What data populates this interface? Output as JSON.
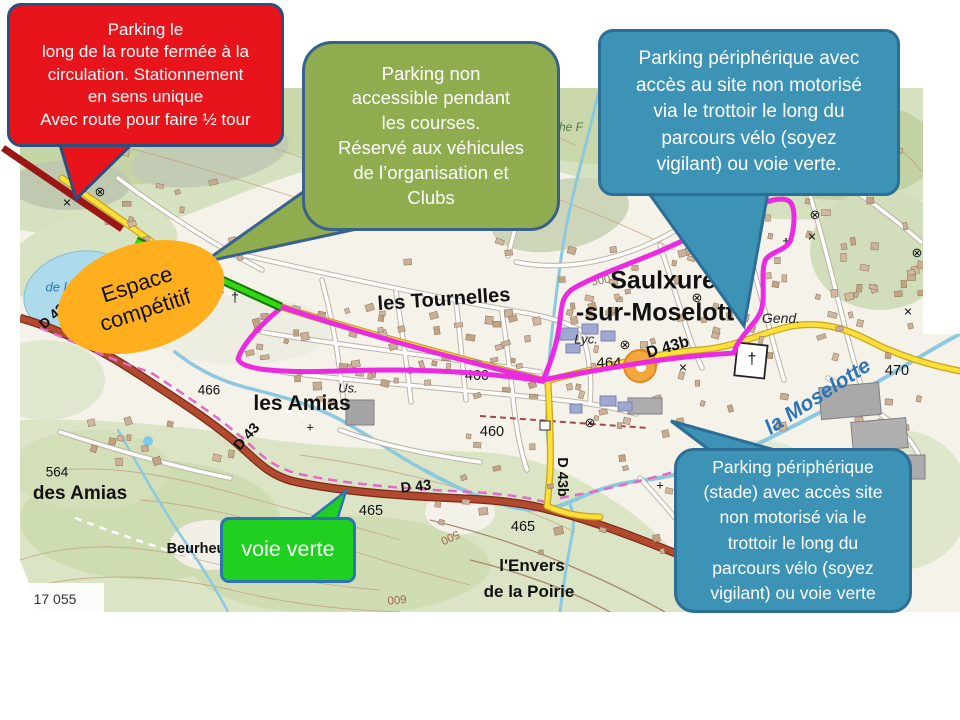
{
  "callouts": {
    "parking_route_fermee": {
      "text": "Parking le\nlong de la route fermée à la\ncirculation. Stationnement\nen sens unique\nAvec route pour faire ½ tour",
      "fill": "#E8141C",
      "border": "#2A5080"
    },
    "parking_non_accessible": {
      "text": "Parking non\naccessible pendant\nles  courses.\nRéservé aux véhicules\nde l’organisation et\nClubs",
      "fill": "#8FAC4F",
      "border": "#38618C"
    },
    "parking_peripherique_nord": {
      "text": "Parking périphérique   avec\naccès au site non motorisé\nvia le  trottoir le long du\nparcours vélo (soyez\nvigilant) ou voie verte.",
      "fill": "#3D93B5",
      "border": "#2C6E96"
    },
    "parking_peripherique_stade": {
      "text": "Parking périphérique\n(stade)  avec  accès site\nnon motorisé via le\ntrottoir le long  du\nparcours vélo (soyez\nvigilant) ou voie verte",
      "fill": "#3D93B5",
      "border": "#2C6E96"
    },
    "espace_competitif": {
      "text": "Espace\ncompétitif",
      "fill": "#FFAF1E"
    },
    "voie_verte": {
      "text": "voie verte",
      "fill": "#20D020",
      "border": "#2E74B5"
    }
  },
  "overlay_colors": {
    "parcours_route": "#EA2BE2",
    "route_fermee_line": "#9D1616",
    "acces_organisation_line": "#35D613"
  },
  "map_labels": [
    {
      "t": "les Tournelles",
      "x": 444,
      "y": 300,
      "s": 20,
      "w": 600,
      "rot": -4
    },
    {
      "t": "Saulxures",
      "x": 670,
      "y": 281,
      "s": 25,
      "w": 700
    },
    {
      "t": "-sur-Moselotte",
      "x": 662,
      "y": 313,
      "s": 25,
      "w": 700
    },
    {
      "t": "les Amias",
      "x": 302,
      "y": 404,
      "s": 21,
      "w": 700
    },
    {
      "t": "des Amias",
      "x": 80,
      "y": 494,
      "s": 19,
      "w": 600
    },
    {
      "t": "564",
      "x": 57,
      "y": 472,
      "s": 13.5
    },
    {
      "t": "Beurheu",
      "x": 196,
      "y": 549,
      "s": 14.5,
      "w": 600
    },
    {
      "t": "l'Envers",
      "x": 532,
      "y": 566,
      "s": 17,
      "w": 700
    },
    {
      "t": "de la Poirie",
      "x": 529,
      "y": 592,
      "s": 17,
      "w": 700
    },
    {
      "t": "la Moselotte",
      "x": 818,
      "y": 397,
      "s": 21,
      "c": "#2C74B8",
      "i": 1,
      "rot": -33,
      "w": 600
    },
    {
      "t": "Gend.",
      "x": 781,
      "y": 318,
      "s": 14,
      "c": "#222",
      "i": 1
    },
    {
      "t": "Lyc.",
      "x": 586,
      "y": 339,
      "s": 13,
      "c": "#222",
      "i": 1
    },
    {
      "t": "Us.",
      "x": 348,
      "y": 388,
      "s": 13,
      "c": "#222",
      "i": 1
    },
    {
      "t": "464",
      "x": 609,
      "y": 363,
      "s": 15
    },
    {
      "t": "466",
      "x": 209,
      "y": 390,
      "s": 13.5
    },
    {
      "t": "460",
      "x": 477,
      "y": 376,
      "s": 14.5
    },
    {
      "t": "460",
      "x": 492,
      "y": 432,
      "s": 14.5
    },
    {
      "t": "465",
      "x": 371,
      "y": 511,
      "s": 14.5
    },
    {
      "t": "465",
      "x": 523,
      "y": 527,
      "s": 14.5
    },
    {
      "t": "470",
      "x": 897,
      "y": 371,
      "s": 14.5
    },
    {
      "t": "D 43",
      "x": 52,
      "y": 316,
      "s": 14,
      "rot": -42,
      "w": 600
    },
    {
      "t": "D 43",
      "x": 247,
      "y": 437,
      "s": 14.5,
      "rot": -48,
      "w": 600
    },
    {
      "t": "D 43",
      "x": 416,
      "y": 487,
      "s": 14.5,
      "rot": -6,
      "w": 600
    },
    {
      "t": "D 43b",
      "x": 668,
      "y": 348,
      "s": 16,
      "rot": -16,
      "w": 600
    },
    {
      "t": "D 43b",
      "x": 562,
      "y": 477,
      "s": 14.5,
      "rot": 90,
      "w": 600
    },
    {
      "t": "500",
      "x": 601,
      "y": 281,
      "s": 11.5,
      "c": "#7D7D55",
      "rot": -10
    },
    {
      "t": "500",
      "x": 450,
      "y": 537,
      "s": 11.5,
      "c": "#A06A4A",
      "rot": 155
    },
    {
      "t": "600",
      "x": 397,
      "y": 599,
      "s": 11.5,
      "c": "#A06A4A",
      "rot": 175
    },
    {
      "t": "che F",
      "x": 568,
      "y": 127,
      "s": 12,
      "c": "#4A7A3E",
      "i": 1
    },
    {
      "t": "de l",
      "x": 56,
      "y": 287,
      "s": 13,
      "c": "#2C74B8",
      "i": 1
    },
    {
      "t": "Parc",
      "x": 211,
      "y": 291,
      "s": 13,
      "c": "#B94A3E",
      "i": 1,
      "rot": -8
    },
    {
      "t": "isirs",
      "x": 189,
      "y": 311,
      "s": 13,
      "c": "#B94A3E",
      "i": 1,
      "rot": -8
    },
    {
      "t": "17 055",
      "x": 55,
      "y": 599,
      "s": 14,
      "c": "#333"
    },
    {
      "t": "⊗",
      "x": 100,
      "y": 192,
      "s": 13
    },
    {
      "t": "⊗",
      "x": 625,
      "y": 345,
      "s": 13
    },
    {
      "t": "⊗",
      "x": 697,
      "y": 298,
      "s": 13
    },
    {
      "t": "⊗",
      "x": 815,
      "y": 215,
      "s": 13
    },
    {
      "t": "⊗",
      "x": 917,
      "y": 253,
      "s": 13
    },
    {
      "t": "⊗",
      "x": 590,
      "y": 423,
      "s": 13
    },
    {
      "t": "✕",
      "x": 67,
      "y": 203,
      "s": 11
    },
    {
      "t": "✕",
      "x": 683,
      "y": 368,
      "s": 11
    },
    {
      "t": "✕",
      "x": 908,
      "y": 312,
      "s": 11
    },
    {
      "t": "✕",
      "x": 812,
      "y": 237,
      "s": 11
    },
    {
      "t": "†",
      "x": 786,
      "y": 243,
      "s": 14
    },
    {
      "t": "†",
      "x": 729,
      "y": 300,
      "s": 14
    },
    {
      "t": "†",
      "x": 235,
      "y": 297,
      "s": 14
    },
    {
      "t": "†",
      "x": 752,
      "y": 360,
      "s": 16
    },
    {
      "t": "+",
      "x": 310,
      "y": 427,
      "s": 13
    },
    {
      "t": "+",
      "x": 660,
      "y": 485,
      "s": 13
    }
  ]
}
